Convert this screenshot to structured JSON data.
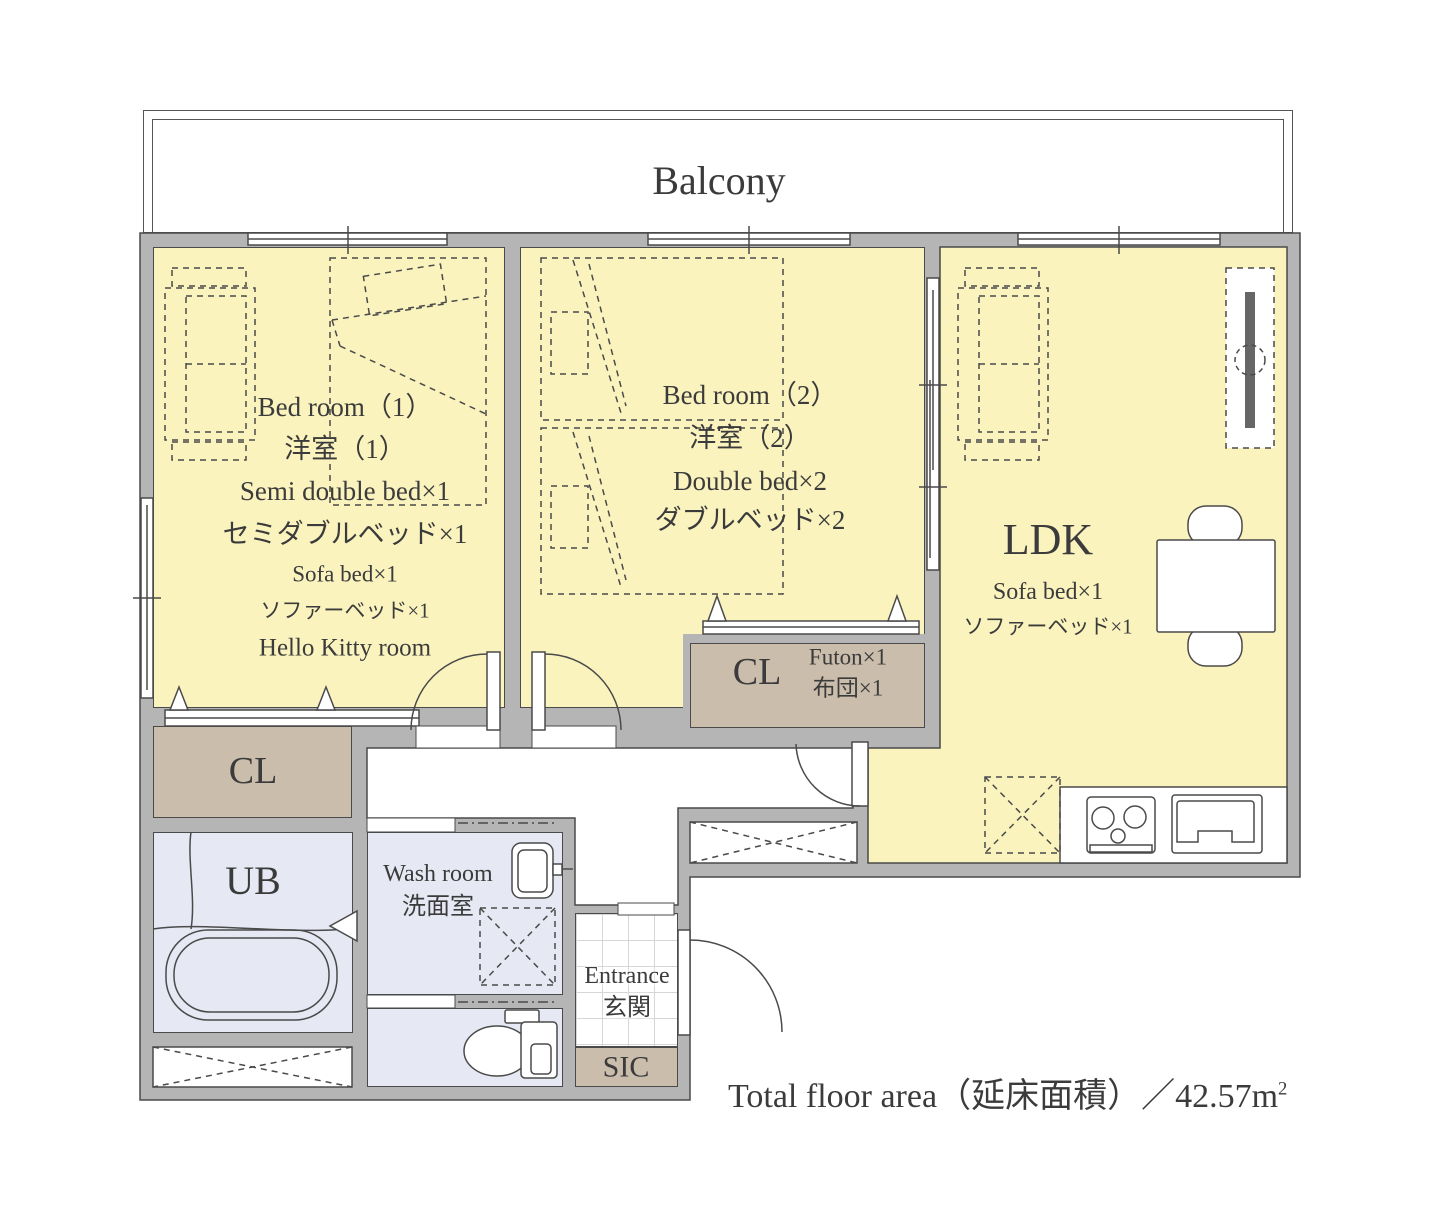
{
  "colors": {
    "room_yellow": "#faf3be",
    "closet_tan": "#cbbdac",
    "bath_lavender": "#e6e8f3",
    "wall_gray": "#b5b5b5",
    "line": "#4a4a4a",
    "text": "#3b3b3b",
    "tv_dark": "#666666"
  },
  "balcony": {
    "label": "Balcony"
  },
  "bedroom1": {
    "name_en": "Bed room（1）",
    "name_ja": "洋室（1）",
    "bed_en": "Semi double bed×1",
    "bed_ja": "セミダブルベッド×1",
    "sofa_en": "Sofa bed×1",
    "sofa_ja": "ソファーベッド×1",
    "note": "Hello Kitty room"
  },
  "bedroom2": {
    "name_en": "Bed room（2）",
    "name_ja": "洋室（2）",
    "bed_en": "Double bed×2",
    "bed_ja": "ダブルベッド×2"
  },
  "ldk": {
    "name": "LDK",
    "sofa_en": "Sofa bed×1",
    "sofa_ja": "ソファーベッド×1"
  },
  "closet_futon": {
    "name": "CL",
    "item_en": "Futon×1",
    "item_ja": "布団×1"
  },
  "closet_hall": {
    "name": "CL"
  },
  "unit_bath": {
    "name": "UB"
  },
  "washroom": {
    "name_en": "Wash room",
    "name_ja": "洗面室"
  },
  "entrance": {
    "name_en": "Entrance",
    "name_ja": "玄関"
  },
  "shoe_closet": {
    "name": "SIC"
  },
  "footer": {
    "label": "Total floor area（延床面積）／42.57",
    "unit": "m",
    "unit_exp": "2"
  }
}
